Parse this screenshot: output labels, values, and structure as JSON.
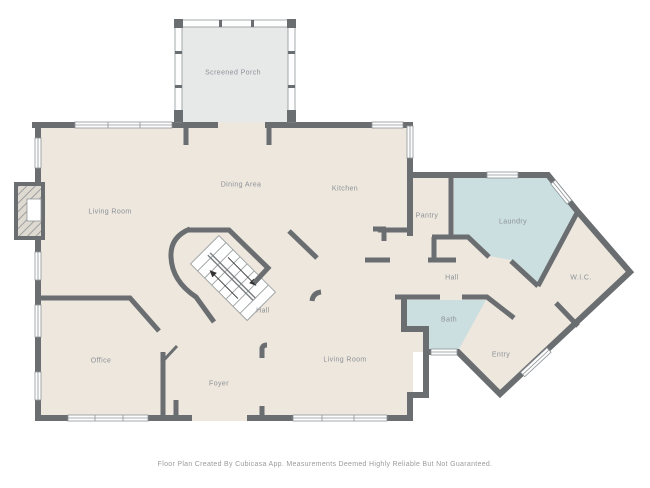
{
  "colors": {
    "bg": "#FFFFFF",
    "floor": "#EDE7DE",
    "porch": "#E7E9E9",
    "wet_room": "#CBDFE1",
    "wall": "#6A6E71",
    "label": "#8C9195",
    "footer_text": "#9B9B9B"
  },
  "rooms": [
    {
      "id": "screened-porch",
      "label": "Screened Porch"
    },
    {
      "id": "living-room-upper",
      "label": "Living Room"
    },
    {
      "id": "dining-area",
      "label": "Dining Area"
    },
    {
      "id": "kitchen",
      "label": "Kitchen"
    },
    {
      "id": "pantry",
      "label": "Pantry"
    },
    {
      "id": "laundry",
      "label": "Laundry"
    },
    {
      "id": "hall-upper",
      "label": "Hall"
    },
    {
      "id": "wic",
      "label": "W.I.C."
    },
    {
      "id": "bath",
      "label": "Bath"
    },
    {
      "id": "hall-center",
      "label": "Hall"
    },
    {
      "id": "living-room-lower",
      "label": "Living Room"
    },
    {
      "id": "office",
      "label": "Office"
    },
    {
      "id": "foyer",
      "label": "Foyer"
    },
    {
      "id": "entry",
      "label": "Entry"
    }
  ],
  "footer": {
    "text": "Floor Plan Created By Cubicasa App. Measurements Deemed Highly Reliable But Not Guaranteed."
  }
}
